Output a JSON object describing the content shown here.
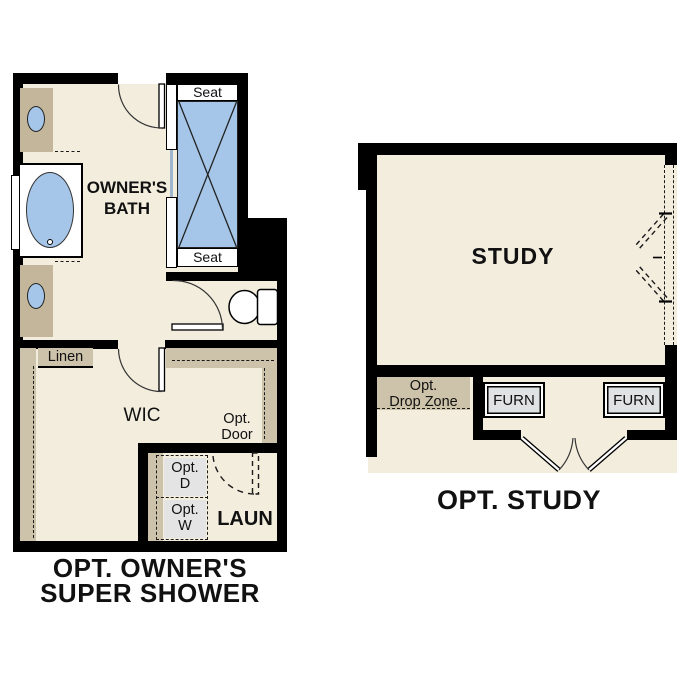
{
  "colors": {
    "wall": "#000000",
    "floor": "#f3edde",
    "counter_tan": "#c3b69b",
    "shelf_tan": "#cdc2aa",
    "fixture_blue": "#a5c6e9",
    "appliance_gray": "#e4e4e4",
    "background": "#ffffff"
  },
  "left_plan": {
    "caption": {
      "line1": "OPT. OWNER'S",
      "line2": "SUPER SHOWER"
    },
    "bath": {
      "label_line1": "OWNER'S",
      "label_line2": "BATH"
    },
    "shower": {
      "seat_top": "Seat",
      "seat_bottom": "Seat"
    },
    "wic": {
      "label": "WIC",
      "linen": "Linen"
    },
    "opt_door": {
      "line1": "Opt.",
      "line2": "Door"
    },
    "laundry": {
      "label": "LAUN",
      "opt_dryer_line1": "Opt.",
      "opt_dryer_line2": "D",
      "opt_washer_line1": "Opt.",
      "opt_washer_line2": "W"
    }
  },
  "right_plan": {
    "caption": "OPT. STUDY",
    "study_label": "STUDY",
    "drop_zone": {
      "line1": "Opt.",
      "line2": "Drop Zone"
    },
    "furn_left": "FURN",
    "furn_right": "FURN"
  }
}
